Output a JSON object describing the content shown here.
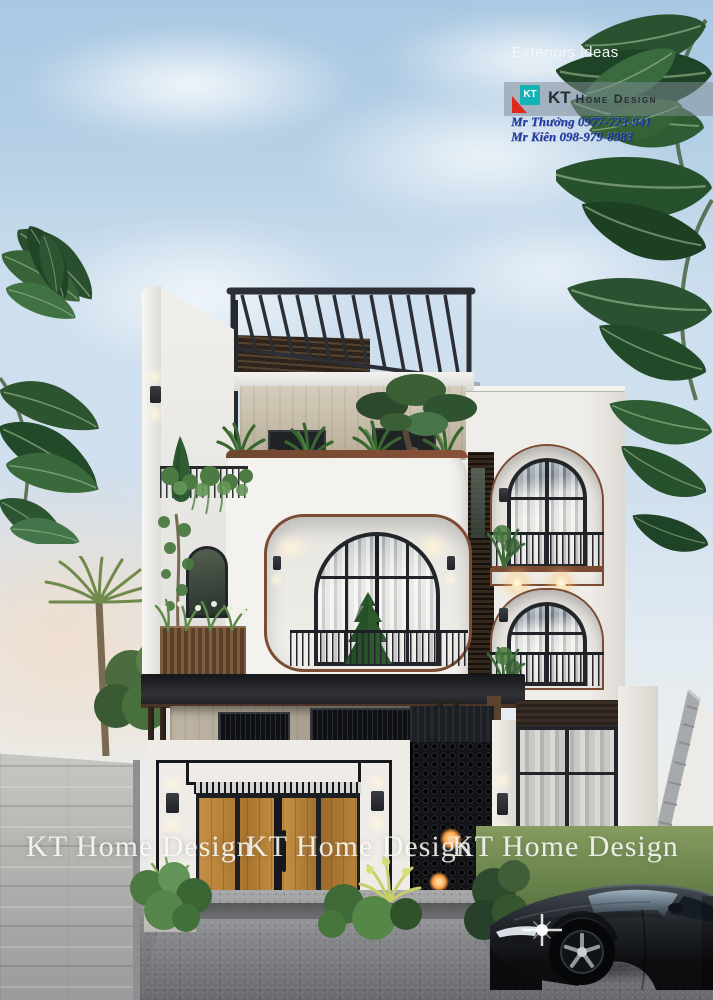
{
  "header": {
    "tagline": "Exteriors ideas",
    "design_by": "Design by",
    "logo": {
      "icon_text": "KT",
      "brand_primary": "KT",
      "brand_secondary": "Home Design"
    },
    "contacts": [
      "Mr Thưởng 0977-723-941",
      "Mr Kiên 098-979-8983"
    ]
  },
  "watermarks": [
    "KT Home Design",
    "KT Home Design",
    "KT Home Design"
  ],
  "colors": {
    "logo_teal": "#12b2b5",
    "logo_red": "#e0281e",
    "banner_text": "#272d36",
    "contact_blue": "#1d3aa8",
    "watermark_white": "#fafaf7",
    "sky_top": "#a9c8e2",
    "facade_white": "#f3f2ee",
    "trim_brown": "#7c4b34",
    "frame_dark": "#22252a",
    "wood_door": "#b5803f",
    "road_gray": "#7c7e82",
    "lawn_green": "#5d7a45"
  }
}
